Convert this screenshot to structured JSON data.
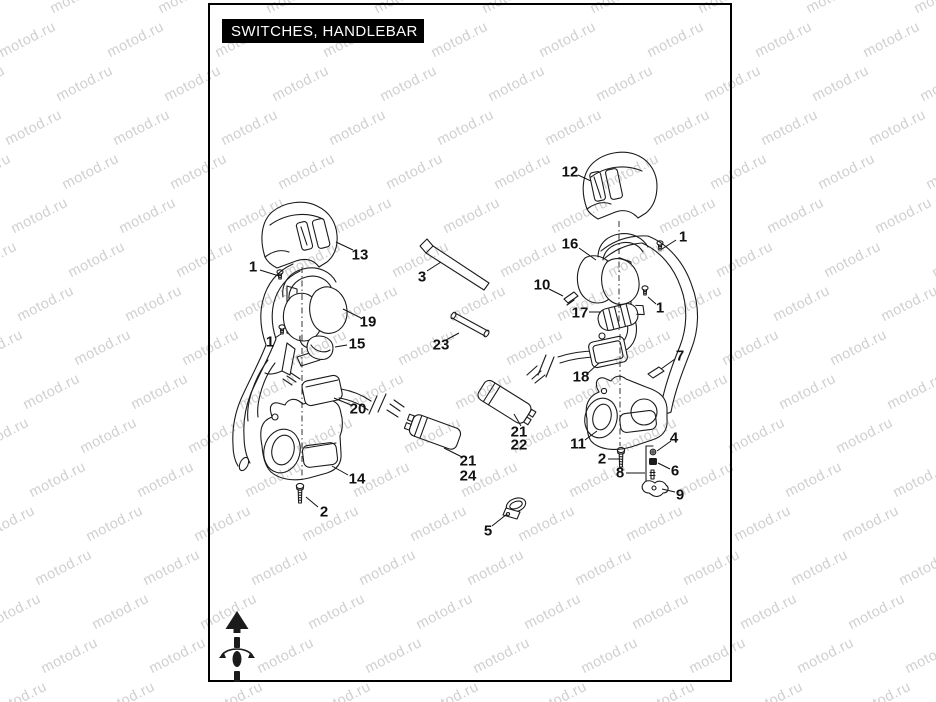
{
  "title": "SWITCHES, HANDLEBAR",
  "watermark": {
    "text": "motod.ru",
    "color": "#cfcfcf"
  },
  "callouts": [
    {
      "label": "13",
      "x": 360,
      "y": 255,
      "leader": [
        353,
        250,
        336,
        242
      ]
    },
    {
      "label": "1",
      "x": 253,
      "y": 267,
      "leader": [
        260,
        270,
        279,
        276
      ]
    },
    {
      "label": "19",
      "x": 368,
      "y": 322,
      "leader": [
        361,
        318,
        343,
        309
      ]
    },
    {
      "label": "15",
      "x": 357,
      "y": 344,
      "leader": [
        347,
        345,
        335,
        347
      ]
    },
    {
      "label": "1",
      "x": 270,
      "y": 342,
      "leader": [
        275,
        338,
        281,
        334
      ]
    },
    {
      "label": "20",
      "x": 358,
      "y": 409,
      "leader": [
        351,
        405,
        334,
        398
      ]
    },
    {
      "label": "14",
      "x": 357,
      "y": 479,
      "leader": [
        348,
        475,
        332,
        466
      ]
    },
    {
      "label": "2",
      "x": 324,
      "y": 512,
      "leader": [
        318,
        507,
        306,
        497
      ]
    },
    {
      "label": "3",
      "x": 422,
      "y": 277,
      "leader": [
        427,
        271,
        441,
        262
      ]
    },
    {
      "label": "23",
      "x": 441,
      "y": 345,
      "leader": [
        446,
        340,
        459,
        333
      ]
    },
    {
      "label": "21",
      "x": 468,
      "y": 461,
      "leader": [
        462,
        457,
        444,
        448
      ]
    },
    {
      "label": "24",
      "x": 468,
      "y": 476,
      "leader": null
    },
    {
      "label": "5",
      "x": 488,
      "y": 531,
      "leader": [
        492,
        526,
        507,
        514
      ]
    },
    {
      "label": "21",
      "x": 519,
      "y": 432,
      "leader": [
        521,
        426,
        514,
        414
      ]
    },
    {
      "label": "22",
      "x": 519,
      "y": 445,
      "leader": null
    },
    {
      "label": "12",
      "x": 570,
      "y": 172,
      "leader": [
        578,
        175,
        591,
        181
      ]
    },
    {
      "label": "16",
      "x": 570,
      "y": 244,
      "leader": [
        579,
        248,
        596,
        260
      ]
    },
    {
      "label": "1",
      "x": 683,
      "y": 237,
      "leader": [
        676,
        240,
        662,
        249
      ]
    },
    {
      "label": "10",
      "x": 542,
      "y": 285,
      "leader": [
        549,
        289,
        563,
        296
      ]
    },
    {
      "label": "17",
      "x": 580,
      "y": 313,
      "leader": [
        589,
        312,
        601,
        312
      ]
    },
    {
      "label": "1",
      "x": 660,
      "y": 308,
      "leader": [
        656,
        304,
        648,
        297
      ]
    },
    {
      "label": "18",
      "x": 581,
      "y": 377,
      "leader": [
        588,
        373,
        599,
        363
      ]
    },
    {
      "label": "7",
      "x": 680,
      "y": 356,
      "leader": [
        675,
        359,
        661,
        369
      ]
    },
    {
      "label": "11",
      "x": 578,
      "y": 444,
      "leader": [
        585,
        440,
        597,
        431
      ]
    },
    {
      "label": "2",
      "x": 602,
      "y": 459,
      "leader": [
        608,
        459,
        619,
        459
      ]
    },
    {
      "label": "4",
      "x": 674,
      "y": 438,
      "leader": [
        671,
        441,
        657,
        451
      ]
    },
    {
      "label": "8",
      "x": 620,
      "y": 473,
      "leader": [
        626,
        473,
        645,
        473
      ]
    },
    {
      "label": "6",
      "x": 675,
      "y": 471,
      "leader": [
        670,
        469,
        658,
        463
      ]
    },
    {
      "label": "9",
      "x": 680,
      "y": 495,
      "leader": [
        675,
        492,
        662,
        489
      ]
    }
  ]
}
